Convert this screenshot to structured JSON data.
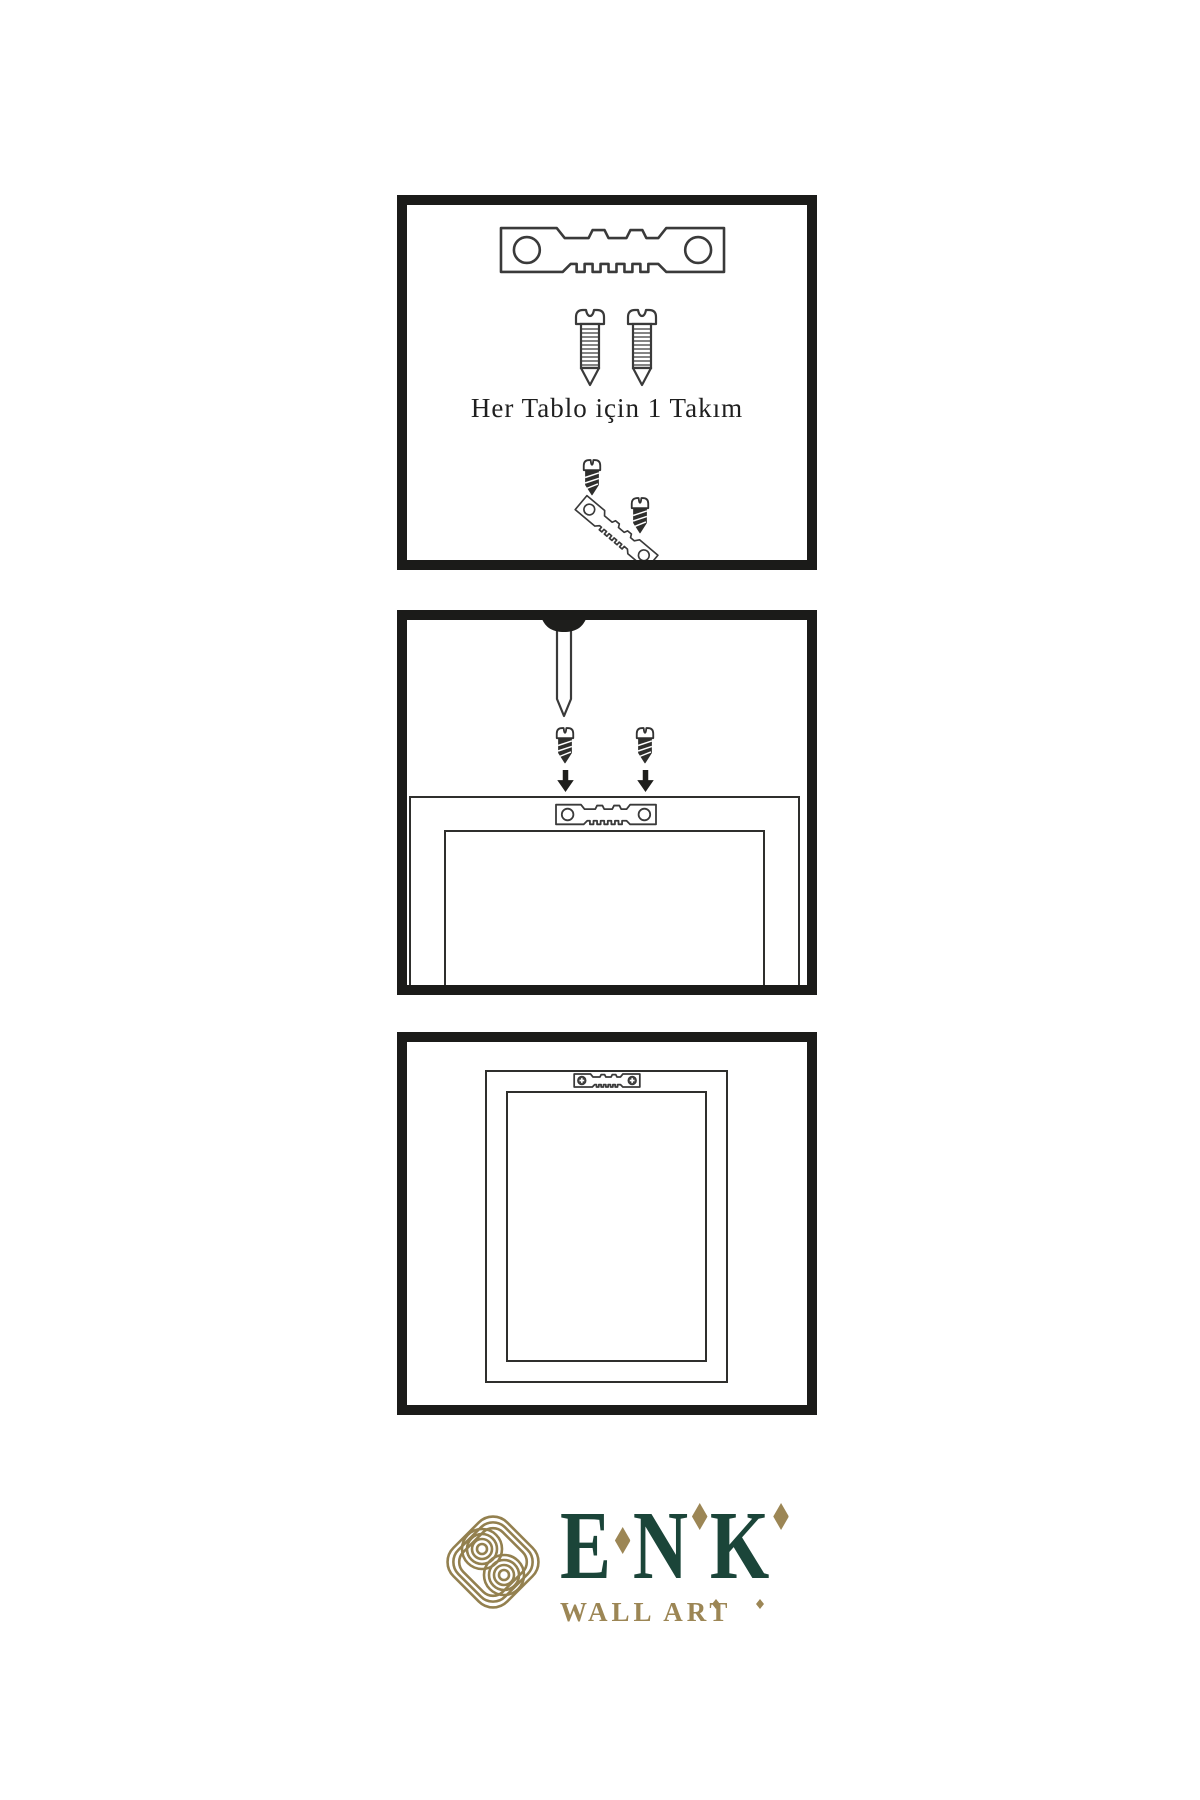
{
  "colors": {
    "ink": "#1b1b19",
    "line_art": "#3a3a3a",
    "brand_green": "#1b4539",
    "brand_gold": "#9c8655"
  },
  "panels": [
    {
      "name": "hardware-kit",
      "caption": "Her Tablo için 1 Takım",
      "icons": [
        "sawtooth-hanger",
        "screw",
        "screw",
        "screw",
        "sawtooth-hanger-angled",
        "screw"
      ]
    },
    {
      "name": "mount-hanger-to-frame-back",
      "icons": [
        "wall-nail",
        "screw",
        "screw",
        "arrow-down",
        "arrow-down",
        "frame-back",
        "sawtooth-hanger"
      ]
    },
    {
      "name": "frame-hung-on-wall",
      "icons": [
        "frame-back",
        "sawtooth-hanger-with-screws"
      ]
    }
  ],
  "brand": {
    "name": "ENK",
    "letters": [
      "E",
      "N",
      "K"
    ],
    "subtitle": "WALL ART",
    "logo": "interlaced-knot"
  }
}
